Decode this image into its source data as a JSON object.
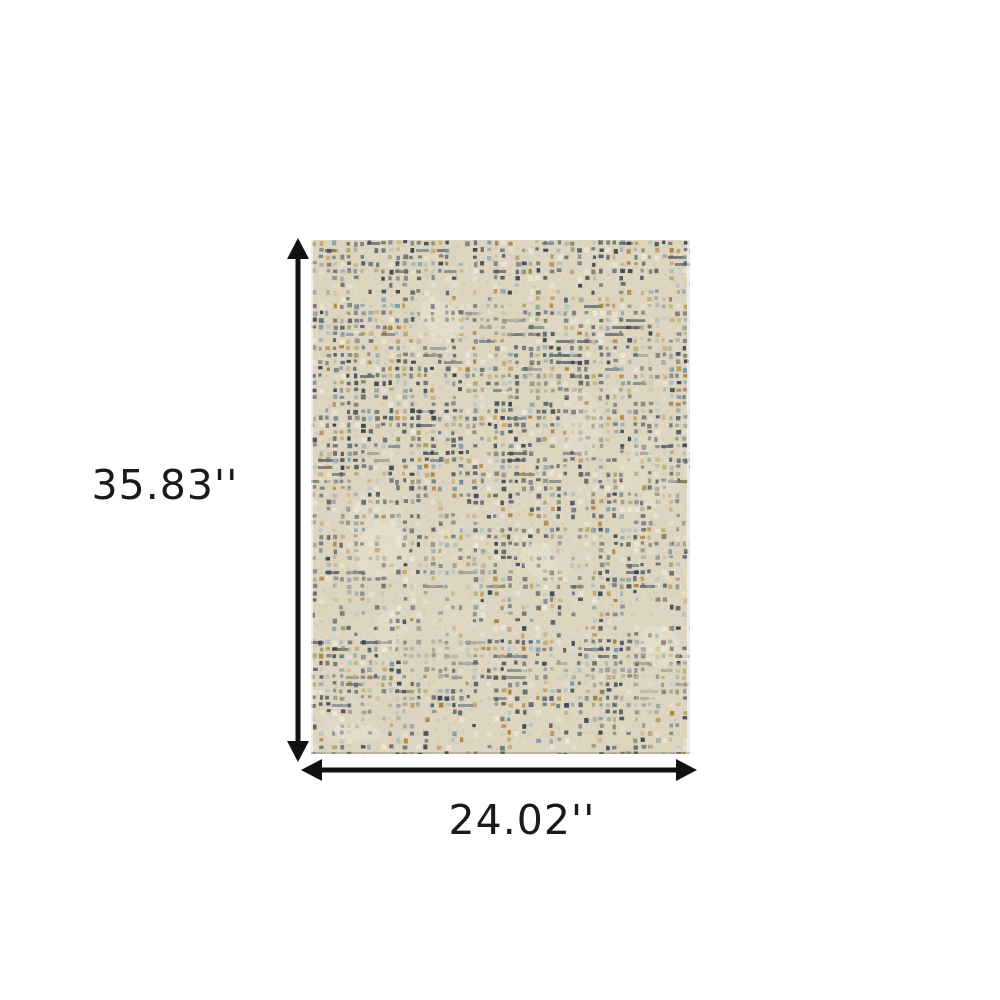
{
  "diagram": {
    "height_label": "35.83''",
    "width_label": "24.02''",
    "arrow_color": "#111111",
    "text_color": "#1a1a1a",
    "background_color": "#ffffff"
  },
  "rug": {
    "description": "beige abstract distressed grid-pattern area rug",
    "base_color": "#ddd5c0",
    "palette": {
      "dark_slate": "#3b4551",
      "slate": "#5d6a74",
      "steel_blue": "#7f9aa3",
      "light_blue": "#a9c0c3",
      "gold": "#a8813a",
      "tan": "#bfa266",
      "khaki": "#8d8468",
      "cream": "#efe9d8"
    }
  }
}
